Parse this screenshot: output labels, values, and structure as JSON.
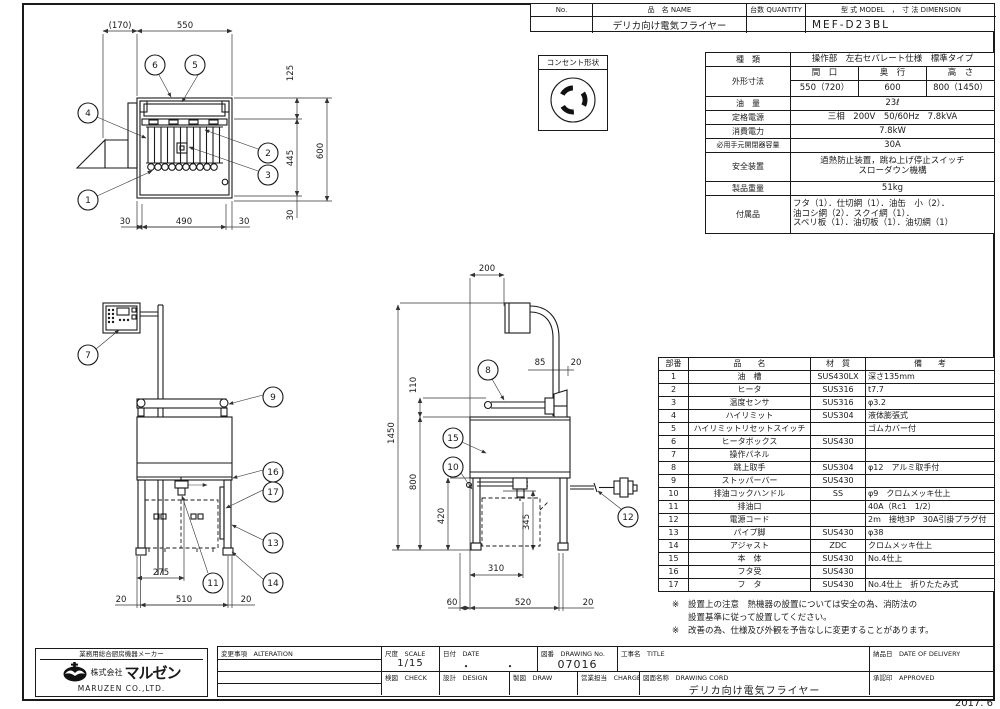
{
  "title_table": {
    "headers": {
      "no": "No.",
      "name": "品　名 NAME",
      "qty": "台数 QUANTITY",
      "model_dim": "型 式 MODEL　，　寸 法 DIMENSION"
    },
    "row": {
      "no": "",
      "name": "デリカ向け電気フライヤー",
      "qty": "",
      "model": "MEF-D23BL"
    }
  },
  "outlet": {
    "label": "コンセント形状"
  },
  "spec": {
    "kind_label": "種　類",
    "kind_value": "操作部　左右セパレート仕様　標準タイプ",
    "dim_label": "外形寸法",
    "w_label": "間　口",
    "d_label": "奥　行",
    "h_label": "高　さ",
    "w_value": "550（720）",
    "d_value": "600",
    "h_value": "800（1450）",
    "oil_label": "油　量",
    "oil_value": "23ℓ",
    "power_label": "定格電源",
    "power_value": "三相　200V　50/60Hz　7.8kVA",
    "consumption_label": "消費電力",
    "consumption_value": "7.8kW",
    "breaker_label": "必用手元開閉器容量",
    "breaker_value": "30A",
    "safety_label": "安全装置",
    "safety_value1": "過熱防止装置，跳ね上げ停止スイッチ",
    "safety_value2": "スローダウン機構",
    "weight_label": "製品重量",
    "weight_value": "51kg",
    "accessory_label": "付属品",
    "accessory_value1": "フタ（1）．仕切網（1）．油缶　小（2）．",
    "accessory_value2": "油コシ網（2）．スクイ網（1）．",
    "accessory_value3": "スベリ板（1）．油切板（1）．油切網（1）"
  },
  "parts_table": {
    "headers": {
      "no": "部番",
      "name": "品　　名",
      "material": "材　質",
      "note": "備　　考"
    },
    "rows": [
      {
        "no": "1",
        "name": "油　槽",
        "material": "SUS430LX",
        "note": "深さ135mm"
      },
      {
        "no": "2",
        "name": "ヒータ",
        "material": "SUS316",
        "note": "t7.7"
      },
      {
        "no": "3",
        "name": "温度センサ",
        "material": "SUS316",
        "note": "φ3.2"
      },
      {
        "no": "4",
        "name": "ハイリミット",
        "material": "SUS304",
        "note": "液体膨張式"
      },
      {
        "no": "5",
        "name": "ハイリミットリセットスイッチ",
        "material": "",
        "note": "ゴムカバー付"
      },
      {
        "no": "6",
        "name": "ヒータボックス",
        "material": "SUS430",
        "note": ""
      },
      {
        "no": "7",
        "name": "操作パネル",
        "material": "",
        "note": ""
      },
      {
        "no": "8",
        "name": "跳上取手",
        "material": "SUS304",
        "note": "φ12　アルミ取手付"
      },
      {
        "no": "9",
        "name": "ストッパーバー",
        "material": "SUS430",
        "note": ""
      },
      {
        "no": "10",
        "name": "排油コックハンドル",
        "material": "SS",
        "note": "φ9　クロムメッキ仕上"
      },
      {
        "no": "11",
        "name": "排油口",
        "material": "",
        "note": "40A（Rc1　1/2）"
      },
      {
        "no": "12",
        "name": "電源コード",
        "material": "",
        "note": "2m　接地3P　30A引掛プラグ付"
      },
      {
        "no": "13",
        "name": "パイプ脚",
        "material": "SUS430",
        "note": "φ38"
      },
      {
        "no": "14",
        "name": "アジャスト",
        "material": "ZDC",
        "note": "クロムメッキ仕上"
      },
      {
        "no": "15",
        "name": "本　体",
        "material": "SUS430",
        "note": "No.4仕上"
      },
      {
        "no": "16",
        "name": "フタ受",
        "material": "SUS430",
        "note": ""
      },
      {
        "no": "17",
        "name": "フ　タ",
        "material": "SUS430",
        "note": "No.4仕上　折りたたみ式"
      }
    ]
  },
  "notes": {
    "mark": "※",
    "note1_line1": "設置上の注意　熱機器の設置については安全の為、消防法の",
    "note1_line2": "設置基準に従って設置してください。",
    "note2": "改善の為、仕様及び外観を予告なしに変更することがあります。"
  },
  "title_block": {
    "company_tagline": "業務用総合厨房機器メーカー",
    "company_prefix": "株式会社",
    "company_name": "マルゼン",
    "company_en": "MARUZEN  CO.,LTD.",
    "alteration_label": "変更事項　ALTERATION",
    "scale_label": "尺度　SCALE",
    "scale_value": "1/15",
    "date_label": "日付　DATE",
    "date_value": "・　　　・",
    "drawing_no_label": "図番　DRAWING No.",
    "drawing_no_value": "07016",
    "title_label": "工事名　TITLE",
    "delivery_label": "納品日　DATE OF DELIVERY",
    "check_label": "検図　CHECK",
    "design_label": "設計　DESIGN",
    "draw_label": "製図　DRAW",
    "charge_label": "営業担当　CHARGE",
    "drawing_cord_label": "図面名称　DRAWING CORD",
    "drawing_cord_value": "デリカ向け電気フライヤー",
    "approved_label": "承認印　APPROVED"
  },
  "sheet": {
    "footer_date": "2017. 6"
  },
  "plan_view": {
    "dims": {
      "offset": "(170)",
      "width": "550",
      "d125": "125",
      "d445": "445",
      "d30r": "30",
      "d600": "600",
      "b30l": "30",
      "b490": "490",
      "b30r": "30"
    },
    "balloons": {
      "b1": "1",
      "b2": "2",
      "b3": "3",
      "b4": "4",
      "b5": "5",
      "b6": "6"
    }
  },
  "front_view": {
    "dims": {
      "d275": "275",
      "d20l": "20",
      "d510": "510",
      "d20r": "20"
    },
    "balloons": {
      "b7": "7",
      "b9": "9",
      "b11": "11",
      "b13": "13",
      "b14": "14",
      "b16": "16",
      "b17": "17"
    }
  },
  "side_view": {
    "dims": {
      "d200": "200",
      "d85": "85",
      "d20t": "20",
      "d110": "110",
      "d1450": "1450",
      "d800": "800",
      "d420": "420",
      "d345": "345",
      "d310": "310",
      "d60": "60",
      "d520": "520",
      "d20b": "20"
    },
    "balloons": {
      "b8": "8",
      "b10": "10",
      "b12": "12",
      "b15": "15"
    }
  }
}
